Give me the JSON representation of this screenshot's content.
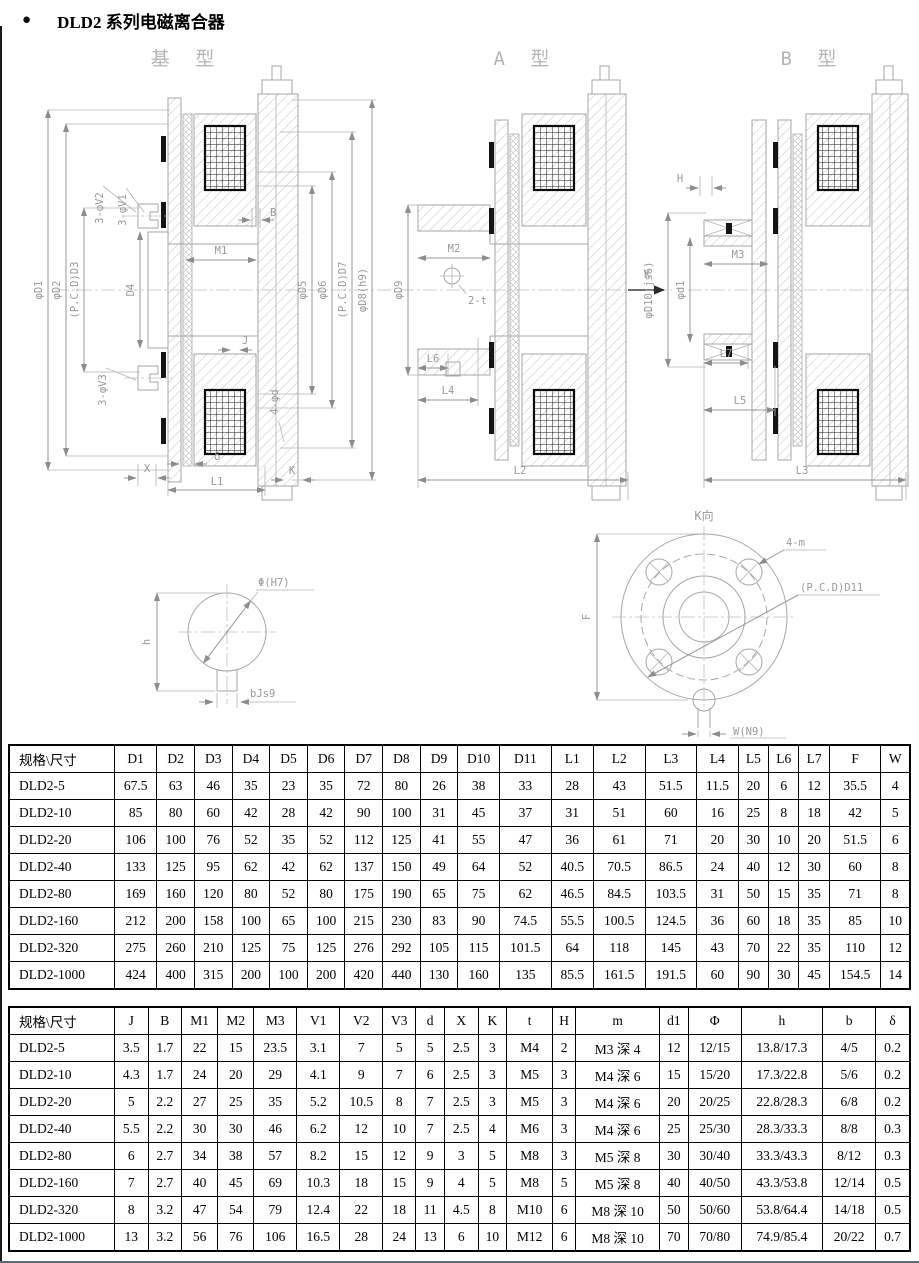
{
  "page": {
    "bullet": "●",
    "title": "DLD2 系列电磁离合器"
  },
  "drawings": {
    "base": {
      "label": "基 型",
      "dims": {
        "phiD1": "φD1",
        "phiD2": "φD2",
        "pcdD3": "(P.C.D)D3",
        "D4": "D4",
        "V2": "3-φV2",
        "V1": "3-φV1",
        "V3": "3-φV3",
        "B": "B",
        "M1": "M1",
        "J": "J",
        "phid": "4-φd",
        "phiD5": "φD5",
        "phiD6": "φD6",
        "pcdD7": "(P.C.D)D7",
        "phiD8": "φD8(h9)",
        "X": "X",
        "delta": "δ",
        "K": "K",
        "L1": "L1"
      }
    },
    "a": {
      "label": "A 型",
      "dims": {
        "phiD9": "φD9",
        "M2": "M2",
        "t2": "2-t",
        "K": "K",
        "L6": "L6",
        "L4": "L4",
        "L2": "L2"
      }
    },
    "b": {
      "label": "B 型",
      "dims": {
        "H": "H",
        "phiD10": "φD10(js6)",
        "phid1": "φd1",
        "M3": "M3",
        "L7": "L7",
        "L5": "L5",
        "L3": "L3"
      }
    },
    "keyway": {
      "dims": {
        "phi": "Φ(H7)",
        "h": "h",
        "b": "bJs9"
      }
    },
    "kview": {
      "label": "K向",
      "dims": {
        "m": "4-m",
        "pcdD11": "(P.C.D)D11",
        "F": "F",
        "W": "W(N9)"
      }
    }
  },
  "tables": {
    "table1": {
      "headers": [
        "规格\\尺寸",
        "D1",
        "D2",
        "D3",
        "D4",
        "D5",
        "D6",
        "D7",
        "D8",
        "D9",
        "D10",
        "D11",
        "L1",
        "L2",
        "L3",
        "L4",
        "L5",
        "L6",
        "L7",
        "F",
        "W"
      ],
      "rows": [
        [
          "DLD2-5",
          "67.5",
          "63",
          "46",
          "35",
          "23",
          "35",
          "72",
          "80",
          "26",
          "38",
          "33",
          "28",
          "43",
          "51.5",
          "11.5",
          "20",
          "6",
          "12",
          "35.5",
          "4"
        ],
        [
          "DLD2-10",
          "85",
          "80",
          "60",
          "42",
          "28",
          "42",
          "90",
          "100",
          "31",
          "45",
          "37",
          "31",
          "51",
          "60",
          "16",
          "25",
          "8",
          "18",
          "42",
          "5"
        ],
        [
          "DLD2-20",
          "106",
          "100",
          "76",
          "52",
          "35",
          "52",
          "112",
          "125",
          "41",
          "55",
          "47",
          "36",
          "61",
          "71",
          "20",
          "30",
          "10",
          "20",
          "51.5",
          "6"
        ],
        [
          "DLD2-40",
          "133",
          "125",
          "95",
          "62",
          "42",
          "62",
          "137",
          "150",
          "49",
          "64",
          "52",
          "40.5",
          "70.5",
          "86.5",
          "24",
          "40",
          "12",
          "30",
          "60",
          "8"
        ],
        [
          "DLD2-80",
          "169",
          "160",
          "120",
          "80",
          "52",
          "80",
          "175",
          "190",
          "65",
          "75",
          "62",
          "46.5",
          "84.5",
          "103.5",
          "31",
          "50",
          "15",
          "35",
          "71",
          "8"
        ],
        [
          "DLD2-160",
          "212",
          "200",
          "158",
          "100",
          "65",
          "100",
          "215",
          "230",
          "83",
          "90",
          "74.5",
          "55.5",
          "100.5",
          "124.5",
          "36",
          "60",
          "18",
          "35",
          "85",
          "10"
        ],
        [
          "DLD2-320",
          "275",
          "260",
          "210",
          "125",
          "75",
          "125",
          "276",
          "292",
          "105",
          "115",
          "101.5",
          "64",
          "118",
          "145",
          "43",
          "70",
          "22",
          "35",
          "110",
          "12"
        ],
        [
          "DLD2-1000",
          "424",
          "400",
          "315",
          "200",
          "100",
          "200",
          "420",
          "440",
          "130",
          "160",
          "135",
          "85.5",
          "161.5",
          "191.5",
          "60",
          "90",
          "30",
          "45",
          "154.5",
          "14"
        ]
      ]
    },
    "table2": {
      "headers": [
        "规格\\尺寸",
        "J",
        "B",
        "M1",
        "M2",
        "M3",
        "V1",
        "V2",
        "V3",
        "d",
        "X",
        "K",
        "t",
        "H",
        "m",
        "d1",
        "Φ",
        "h",
        "b",
        "δ"
      ],
      "rows": [
        [
          "DLD2-5",
          "3.5",
          "1.7",
          "22",
          "15",
          "23.5",
          "3.1",
          "7",
          "5",
          "5",
          "2.5",
          "3",
          "M4",
          "2",
          "M3 深 4",
          "12",
          "12/15",
          "13.8/17.3",
          "4/5",
          "0.2"
        ],
        [
          "DLD2-10",
          "4.3",
          "1.7",
          "24",
          "20",
          "29",
          "4.1",
          "9",
          "7",
          "6",
          "2.5",
          "3",
          "M5",
          "3",
          "M4 深 6",
          "15",
          "15/20",
          "17.3/22.8",
          "5/6",
          "0.2"
        ],
        [
          "DLD2-20",
          "5",
          "2.2",
          "27",
          "25",
          "35",
          "5.2",
          "10.5",
          "8",
          "7",
          "2.5",
          "3",
          "M5",
          "3",
          "M4 深 6",
          "20",
          "20/25",
          "22.8/28.3",
          "6/8",
          "0.2"
        ],
        [
          "DLD2-40",
          "5.5",
          "2.2",
          "30",
          "30",
          "46",
          "6.2",
          "12",
          "10",
          "7",
          "2.5",
          "4",
          "M6",
          "3",
          "M4 深 6",
          "25",
          "25/30",
          "28.3/33.3",
          "8/8",
          "0.3"
        ],
        [
          "DLD2-80",
          "6",
          "2.7",
          "34",
          "38",
          "57",
          "8.2",
          "15",
          "12",
          "9",
          "3",
          "5",
          "M8",
          "3",
          "M5 深 8",
          "30",
          "30/40",
          "33.3/43.3",
          "8/12",
          "0.3"
        ],
        [
          "DLD2-160",
          "7",
          "2.7",
          "40",
          "45",
          "69",
          "10.3",
          "18",
          "15",
          "9",
          "4",
          "5",
          "M8",
          "5",
          "M5 深 8",
          "40",
          "40/50",
          "43.3/53.8",
          "12/14",
          "0.5"
        ],
        [
          "DLD2-320",
          "8",
          "3.2",
          "47",
          "54",
          "79",
          "12.4",
          "22",
          "18",
          "11",
          "4.5",
          "8",
          "M10",
          "6",
          "M8 深 10",
          "50",
          "50/60",
          "53.8/64.4",
          "14/18",
          "0.5"
        ],
        [
          "DLD2-1000",
          "13",
          "3.2",
          "56",
          "76",
          "106",
          "16.5",
          "28",
          "24",
          "13",
          "6",
          "10",
          "M12",
          "6",
          "M8 深 10",
          "70",
          "70/80",
          "74.9/85.4",
          "20/22",
          "0.7"
        ]
      ]
    }
  }
}
